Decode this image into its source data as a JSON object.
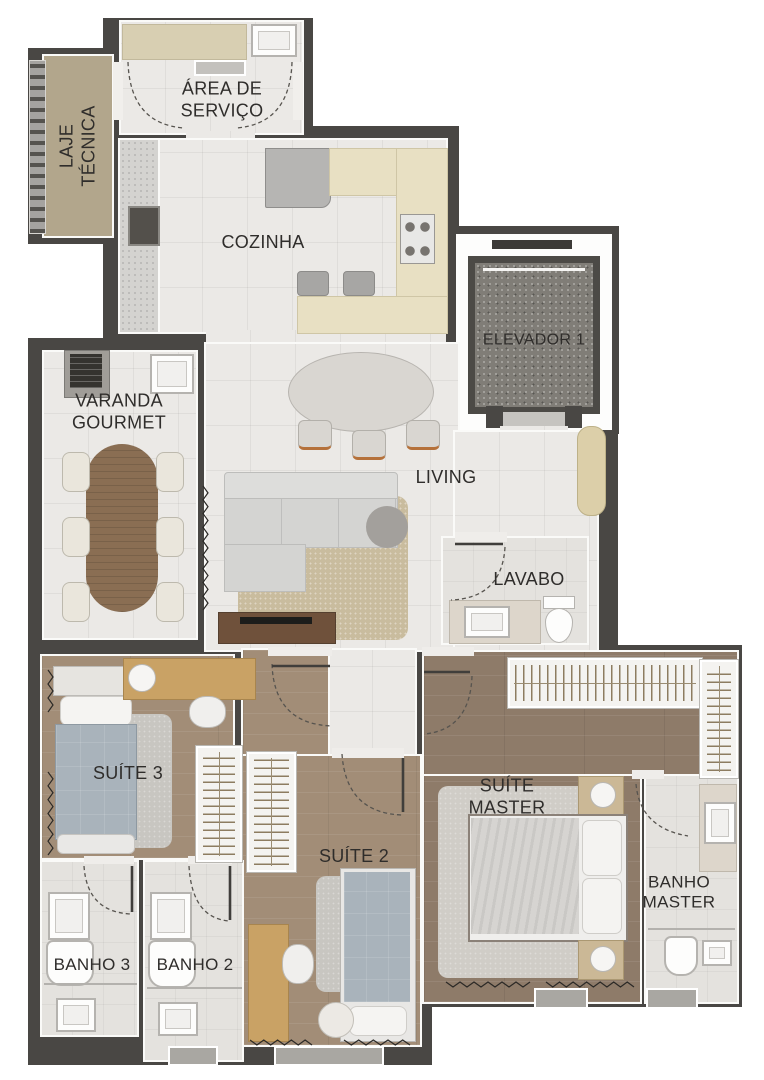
{
  "title": "Planta do apartamento",
  "colors": {
    "wall": "#494744",
    "ink": "#2f2d2b",
    "tile": "#ebe9e6",
    "bath": "#e4e2de",
    "wood": "#a28d77",
    "woodd": "#8e7b69",
    "laje": "#b2a68c",
    "cream": "#e8e0c3",
    "granite": "#d4d3d0",
    "btable": "#8a6e53",
    "rug": "#c9bc9e",
    "rugg": "#c8c6c1",
    "blanket": "#a9b3bb",
    "tan": "#c9a265",
    "console": "#6f513b",
    "shaft": "#807d77"
  },
  "rooms": {
    "laje_tecnica": {
      "label": "LAJE TÉCNICA"
    },
    "area_servico": {
      "label": "ÁREA DE SERVIÇO"
    },
    "cozinha": {
      "label": "COZINHA"
    },
    "elevador": {
      "label": "ELEVADOR 1"
    },
    "varanda": {
      "label": "VARANDA GOURMET"
    },
    "living": {
      "label": "LIVING"
    },
    "lavabo": {
      "label": "LAVABO"
    },
    "suite3": {
      "label": "SUÍTE 3"
    },
    "suite2": {
      "label": "SUÍTE 2"
    },
    "suite_master": {
      "label": "SUÍTE MASTER"
    },
    "banho3": {
      "label": "BANHO 3"
    },
    "banho2": {
      "label": "BANHO 2"
    },
    "banho_master": {
      "label": "BANHO MASTER"
    }
  }
}
